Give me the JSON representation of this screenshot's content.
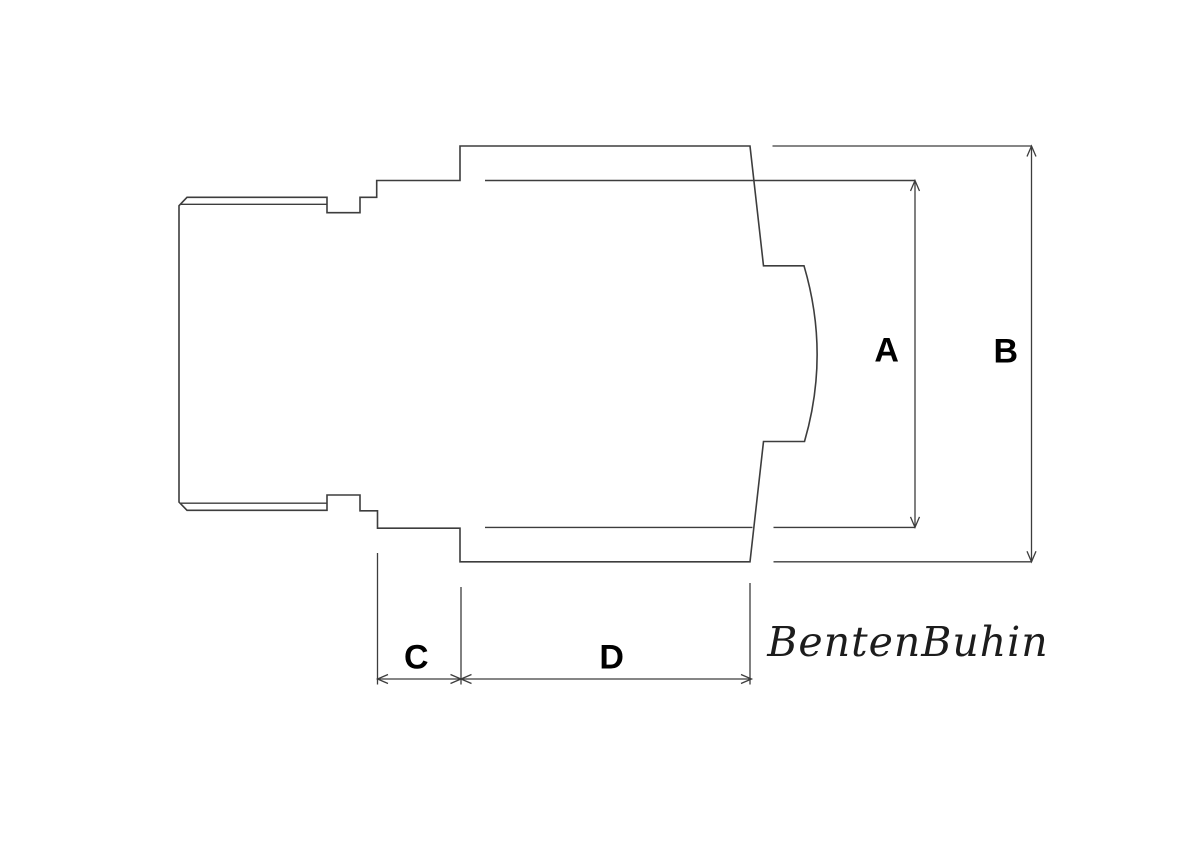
{
  "drawing": {
    "type": "technical-dimension-drawing",
    "dimension_labels": {
      "a": "A",
      "b": "B",
      "c": "C",
      "d": "D"
    },
    "logo_text": "BentenBuhin",
    "colors": {
      "line": "#3d3d3d",
      "label": "#000000",
      "background": "#ffffff"
    }
  }
}
